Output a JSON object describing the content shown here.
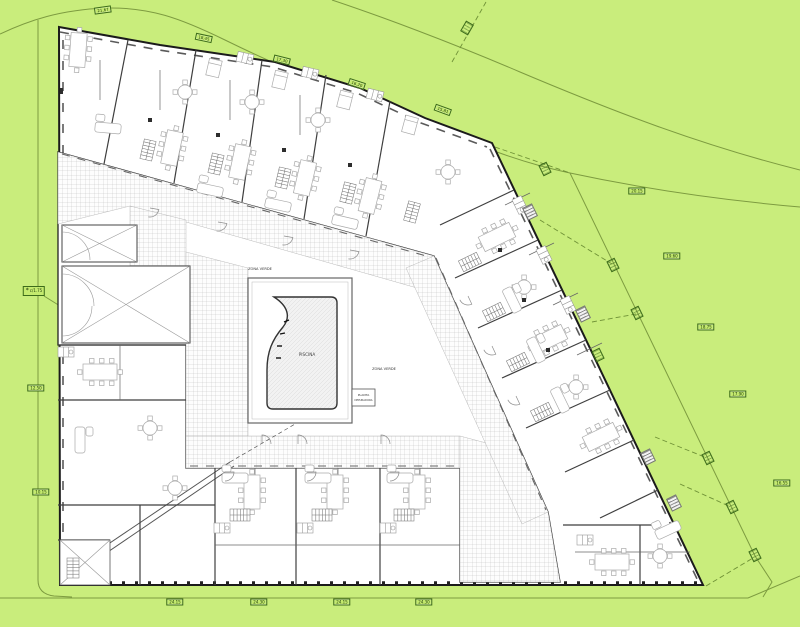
{
  "plan_texts": {
    "piscina": "PISCINA",
    "zona_verde_top": "ZONA VERDE",
    "zona_verde_right": "ZONA VERDE",
    "planta_depuradora_line1": "PLANTA",
    "planta_depuradora_line2": "DEPURADORA"
  },
  "colors": {
    "background": "#c9ed7c",
    "parcel_line": "#7d9b40",
    "dashed_line": "#6f9136",
    "label_fill": "#c4ea6e",
    "label_border": "#3c6b1a",
    "label_text": "#1e3c0a",
    "wall": "#1b1b1b",
    "paving_grid": "#bfbfbf",
    "pool_water": "#f2f2f2"
  },
  "access_marker": {
    "symbol": "*",
    "text": "c/1.75"
  },
  "boundary_labels": [
    {
      "text": "21.67",
      "x": 103,
      "y": 10,
      "rot": -8
    },
    {
      "text": "18.45",
      "x": 204,
      "y": 38,
      "rot": 12
    },
    {
      "text": "17.30",
      "x": 282,
      "y": 60,
      "rot": 14
    },
    {
      "text": "16.20",
      "x": 357,
      "y": 84,
      "rot": 18
    },
    {
      "text": "15.81",
      "x": 443,
      "y": 110,
      "rot": 20
    },
    {
      "text": "20.15",
      "x": 637,
      "y": 191,
      "rot": 0
    },
    {
      "text": "19.60",
      "x": 672,
      "y": 256,
      "rot": 0
    },
    {
      "text": "18.75",
      "x": 706,
      "y": 327,
      "rot": 0
    },
    {
      "text": "17.90",
      "x": 738,
      "y": 394,
      "rot": 0
    },
    {
      "text": "16.55",
      "x": 782,
      "y": 483,
      "rot": 0
    },
    {
      "text": "24.15",
      "x": 175,
      "y": 602,
      "rot": 0
    },
    {
      "text": "24.30",
      "x": 259,
      "y": 602,
      "rot": 0
    },
    {
      "text": "24.15",
      "x": 342,
      "y": 602,
      "rot": 0
    },
    {
      "text": "24.30",
      "x": 424,
      "y": 602,
      "rot": 0
    },
    {
      "text": "12.50",
      "x": 36,
      "y": 388,
      "rot": 0
    },
    {
      "text": "10.15",
      "x": 41,
      "y": 492,
      "rot": 0
    }
  ],
  "survey_markers": [
    {
      "x": 467,
      "y": 28,
      "rot": -60
    },
    {
      "x": 545,
      "y": 169,
      "rot": 64
    },
    {
      "x": 613,
      "y": 265,
      "rot": 64
    },
    {
      "x": 637,
      "y": 313,
      "rot": 64
    },
    {
      "x": 598,
      "y": 355,
      "rot": 64
    },
    {
      "x": 708,
      "y": 458,
      "rot": 64
    },
    {
      "x": 732,
      "y": 507,
      "rot": 64
    },
    {
      "x": 755,
      "y": 555,
      "rot": 64
    }
  ],
  "exterior_stairs": [
    {
      "x": 530,
      "y": 212,
      "rot": 64
    },
    {
      "x": 583,
      "y": 314,
      "rot": 64
    },
    {
      "x": 648,
      "y": 457,
      "rot": 64
    },
    {
      "x": 674,
      "y": 503,
      "rot": 64
    }
  ]
}
